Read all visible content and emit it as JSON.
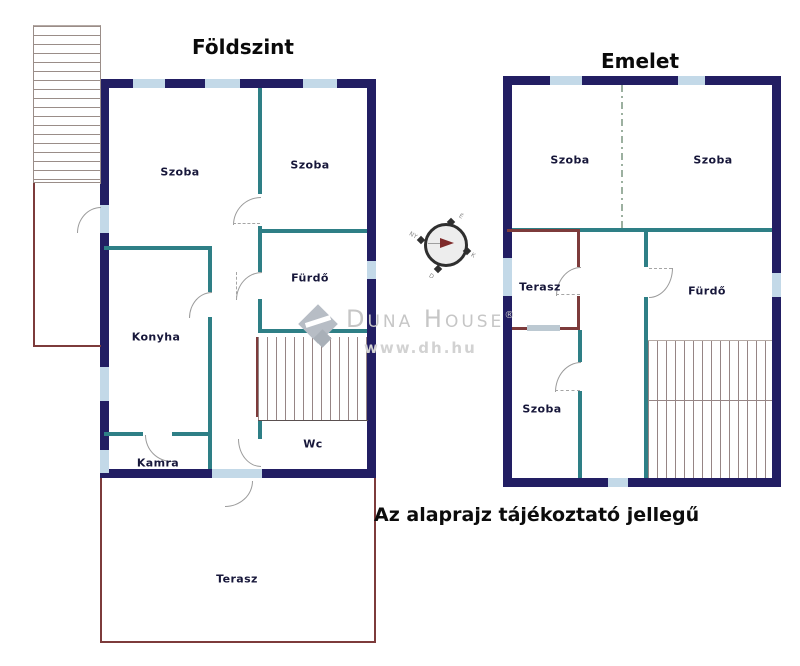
{
  "ground_floor": {
    "title": "Földszint",
    "rooms": {
      "szoba_left": "Szoba",
      "szoba_right": "Szoba",
      "furdo": "Fürdő",
      "konyha": "Konyha",
      "kamra": "Kamra",
      "wc": "Wc",
      "terasz": "Terasz"
    }
  },
  "upper_floor": {
    "title": "Emelet",
    "rooms": {
      "szoba_left": "Szoba",
      "szoba_right": "Szoba",
      "terasz": "Terasz",
      "furdo": "Fürdő",
      "szoba_lower": "Szoba"
    }
  },
  "disclaimer": "Az alaprajz tájékoztató jellegű",
  "watermark": {
    "brand": "Duna House",
    "registered": "®",
    "url": "www.dh.hu"
  },
  "compass": {
    "north": "É",
    "east": "K",
    "south": "D",
    "west": "NY"
  },
  "colors": {
    "exterior_wall": "#221e63",
    "window": "#c3d9e8",
    "interior_wall": "#2e7f86",
    "terrace_wall": "#7d3b3b",
    "hatch_line": "#968585",
    "watermark_gray": "#c6c6c6"
  }
}
